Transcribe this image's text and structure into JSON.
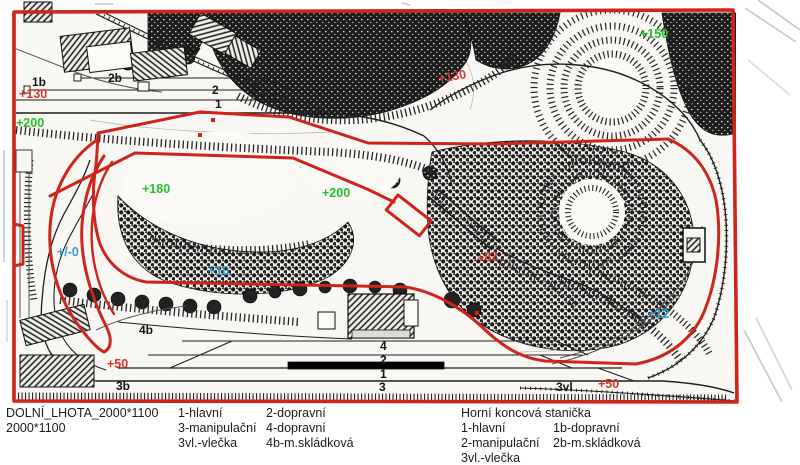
{
  "colors": {
    "outline_red": "#cf241c",
    "label_red": "#d8342c",
    "label_green": "#22c32a",
    "label_blue": "#2f9fd4",
    "ink": "#1b1b1b"
  },
  "map_labels": {
    "elevation_green": [
      "+200",
      "+180",
      "+200",
      "+150"
    ],
    "elevation_blue": [
      "+/-0",
      "+10",
      "+12"
    ],
    "elevation_red": [
      "+130",
      "+130",
      "+82",
      "+50",
      "+50"
    ],
    "top_station_tracks": [
      "1b",
      "2b",
      "3vl",
      "2",
      "1"
    ],
    "bottom_station_tracks": [
      "4b",
      "3b",
      "4",
      "2",
      "1",
      "3",
      "3vl"
    ]
  },
  "footer": {
    "title_line1": "DOLNÍ_LHOTA_2000*1100",
    "title_line2": "2000*1100",
    "left_legend": {
      "rows": [
        [
          "1-hlavní",
          "2-dopravní"
        ],
        [
          "3-manipulační",
          "4-dopravní"
        ],
        [
          "3vl.-vlečka",
          "4b-m.skládková"
        ]
      ]
    },
    "right_legend": {
      "heading": "Horní koncová stanička",
      "rows": [
        [
          "1-hlavní",
          "1b-dopravní"
        ],
        [
          "2-manipulační",
          "2b-m.skládková"
        ],
        [
          "3vl.-vlečka",
          ""
        ]
      ]
    }
  }
}
